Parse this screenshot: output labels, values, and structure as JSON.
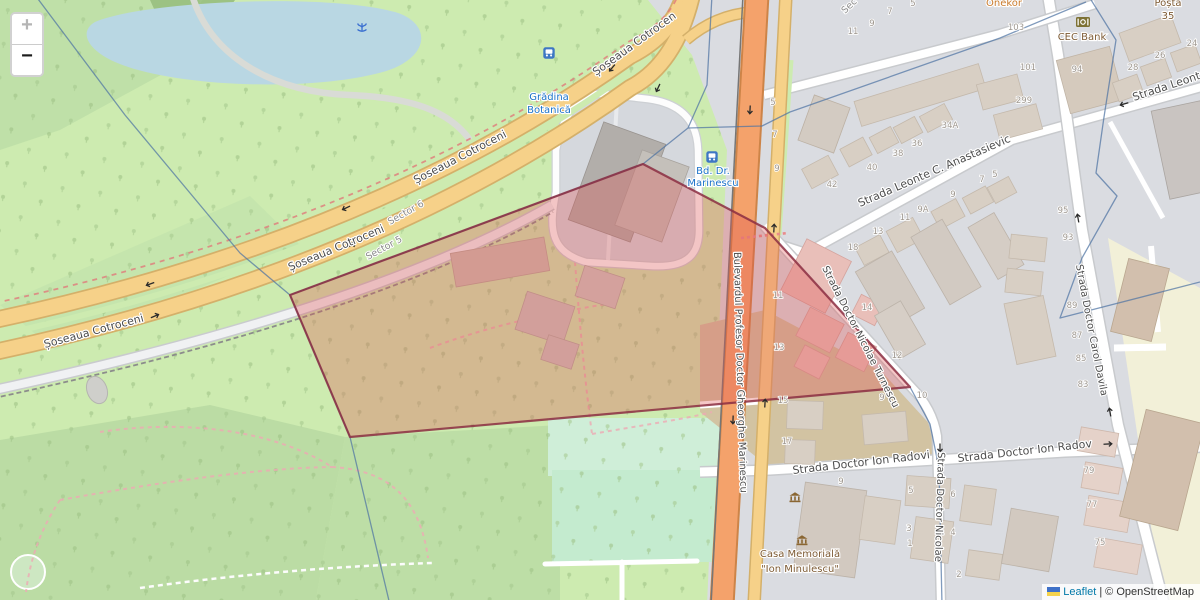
{
  "controls": {
    "zoom_in": "+",
    "zoom_out": "−"
  },
  "attribution": {
    "leaflet": "Leaflet",
    "sep": "|",
    "osm": "© OpenStreetMap"
  },
  "streets": {
    "cotroceni": "Șoseaua Cotroceni",
    "bulevard": "Bulevardul Profesor Doctor Gheorghe Marinescu",
    "turnescu": "Strada Doctor Nicolae Turnescu",
    "nicolae": "Strada Doctor Nicolae",
    "radovici": "Strada Doctor Ion Radovici",
    "anastasievici": "Strada Leonte C. Anastasievici",
    "leonte_partial": "Strada Leont",
    "davila": "Strada Doctor Carol Davila"
  },
  "districts": {
    "sector6": "Sector 6",
    "sector5": "Sector 5",
    "sector_partial": "Sec"
  },
  "pois": {
    "botanical_garden": {
      "line1": "Grădina",
      "line2": "Botanică"
    },
    "marinescu_stop": {
      "line1": "Bd. Dr.",
      "line2": "Marinescu"
    },
    "cec_bank": "CEC Bank",
    "memorial_house": {
      "line1": "Casa Memorială",
      "line2": "\"Ion Minulescu\""
    },
    "post_office": {
      "line1": "Poșta",
      "line2": "35"
    },
    "shop_partial": "Onekor"
  },
  "house_numbers": [
    {
      "t": "101",
      "x": 1028,
      "y": 70
    },
    {
      "t": "299",
      "x": 1024,
      "y": 103
    },
    {
      "t": "94",
      "x": 1077,
      "y": 72
    },
    {
      "t": "28",
      "x": 1133,
      "y": 70
    },
    {
      "t": "26",
      "x": 1160,
      "y": 58
    },
    {
      "t": "24",
      "x": 1192,
      "y": 46
    },
    {
      "t": "103",
      "x": 1016,
      "y": 30
    },
    {
      "t": "5",
      "x": 913,
      "y": 6
    },
    {
      "t": "7",
      "x": 890,
      "y": 14
    },
    {
      "t": "9",
      "x": 872,
      "y": 26
    },
    {
      "t": "11",
      "x": 853,
      "y": 34
    },
    {
      "t": "42",
      "x": 832,
      "y": 187
    },
    {
      "t": "40",
      "x": 872,
      "y": 170
    },
    {
      "t": "38",
      "x": 898,
      "y": 156
    },
    {
      "t": "36",
      "x": 917,
      "y": 146
    },
    {
      "t": "34A",
      "x": 950,
      "y": 128
    },
    {
      "t": "18",
      "x": 853,
      "y": 250
    },
    {
      "t": "13",
      "x": 878,
      "y": 234
    },
    {
      "t": "11",
      "x": 905,
      "y": 220
    },
    {
      "t": "9A",
      "x": 923,
      "y": 212
    },
    {
      "t": "9",
      "x": 953,
      "y": 197
    },
    {
      "t": "7",
      "x": 982,
      "y": 182
    },
    {
      "t": "5",
      "x": 995,
      "y": 177
    },
    {
      "t": "95",
      "x": 1063,
      "y": 213
    },
    {
      "t": "93",
      "x": 1068,
      "y": 240
    },
    {
      "t": "89",
      "x": 1072,
      "y": 308
    },
    {
      "t": "87",
      "x": 1077,
      "y": 338
    },
    {
      "t": "85",
      "x": 1081,
      "y": 361
    },
    {
      "t": "83",
      "x": 1083,
      "y": 387
    },
    {
      "t": "79",
      "x": 1089,
      "y": 473
    },
    {
      "t": "77",
      "x": 1092,
      "y": 507
    },
    {
      "t": "75",
      "x": 1100,
      "y": 545
    },
    {
      "t": "5",
      "x": 773,
      "y": 105
    },
    {
      "t": "7",
      "x": 775,
      "y": 137
    },
    {
      "t": "9",
      "x": 777,
      "y": 171
    },
    {
      "t": "11",
      "x": 778,
      "y": 298
    },
    {
      "t": "13",
      "x": 779,
      "y": 350
    },
    {
      "t": "15",
      "x": 783,
      "y": 403
    },
    {
      "t": "17",
      "x": 787,
      "y": 444
    },
    {
      "t": "14",
      "x": 867,
      "y": 310
    },
    {
      "t": "12",
      "x": 897,
      "y": 358
    },
    {
      "t": "10",
      "x": 922,
      "y": 398
    },
    {
      "t": "9",
      "x": 882,
      "y": 400
    },
    {
      "t": "9",
      "x": 841,
      "y": 484
    },
    {
      "t": "5",
      "x": 911,
      "y": 493
    },
    {
      "t": "3",
      "x": 909,
      "y": 531
    },
    {
      "t": "1",
      "x": 910,
      "y": 546
    },
    {
      "t": "6",
      "x": 953,
      "y": 497
    },
    {
      "t": "4",
      "x": 953,
      "y": 535
    },
    {
      "t": "2",
      "x": 959,
      "y": 577
    }
  ],
  "colors": {
    "highlight_fill": "#e05252",
    "highlight_stroke": "#8b2e42",
    "boundary": "#4f74a3",
    "road_trunk": "#f4a26b",
    "road_primary": "#f6d189",
    "park": "#cdebb0",
    "urban": "#dadce1",
    "water": "#b9d7e3",
    "link": "#0078a8",
    "transit_label": "#1b72c8"
  }
}
